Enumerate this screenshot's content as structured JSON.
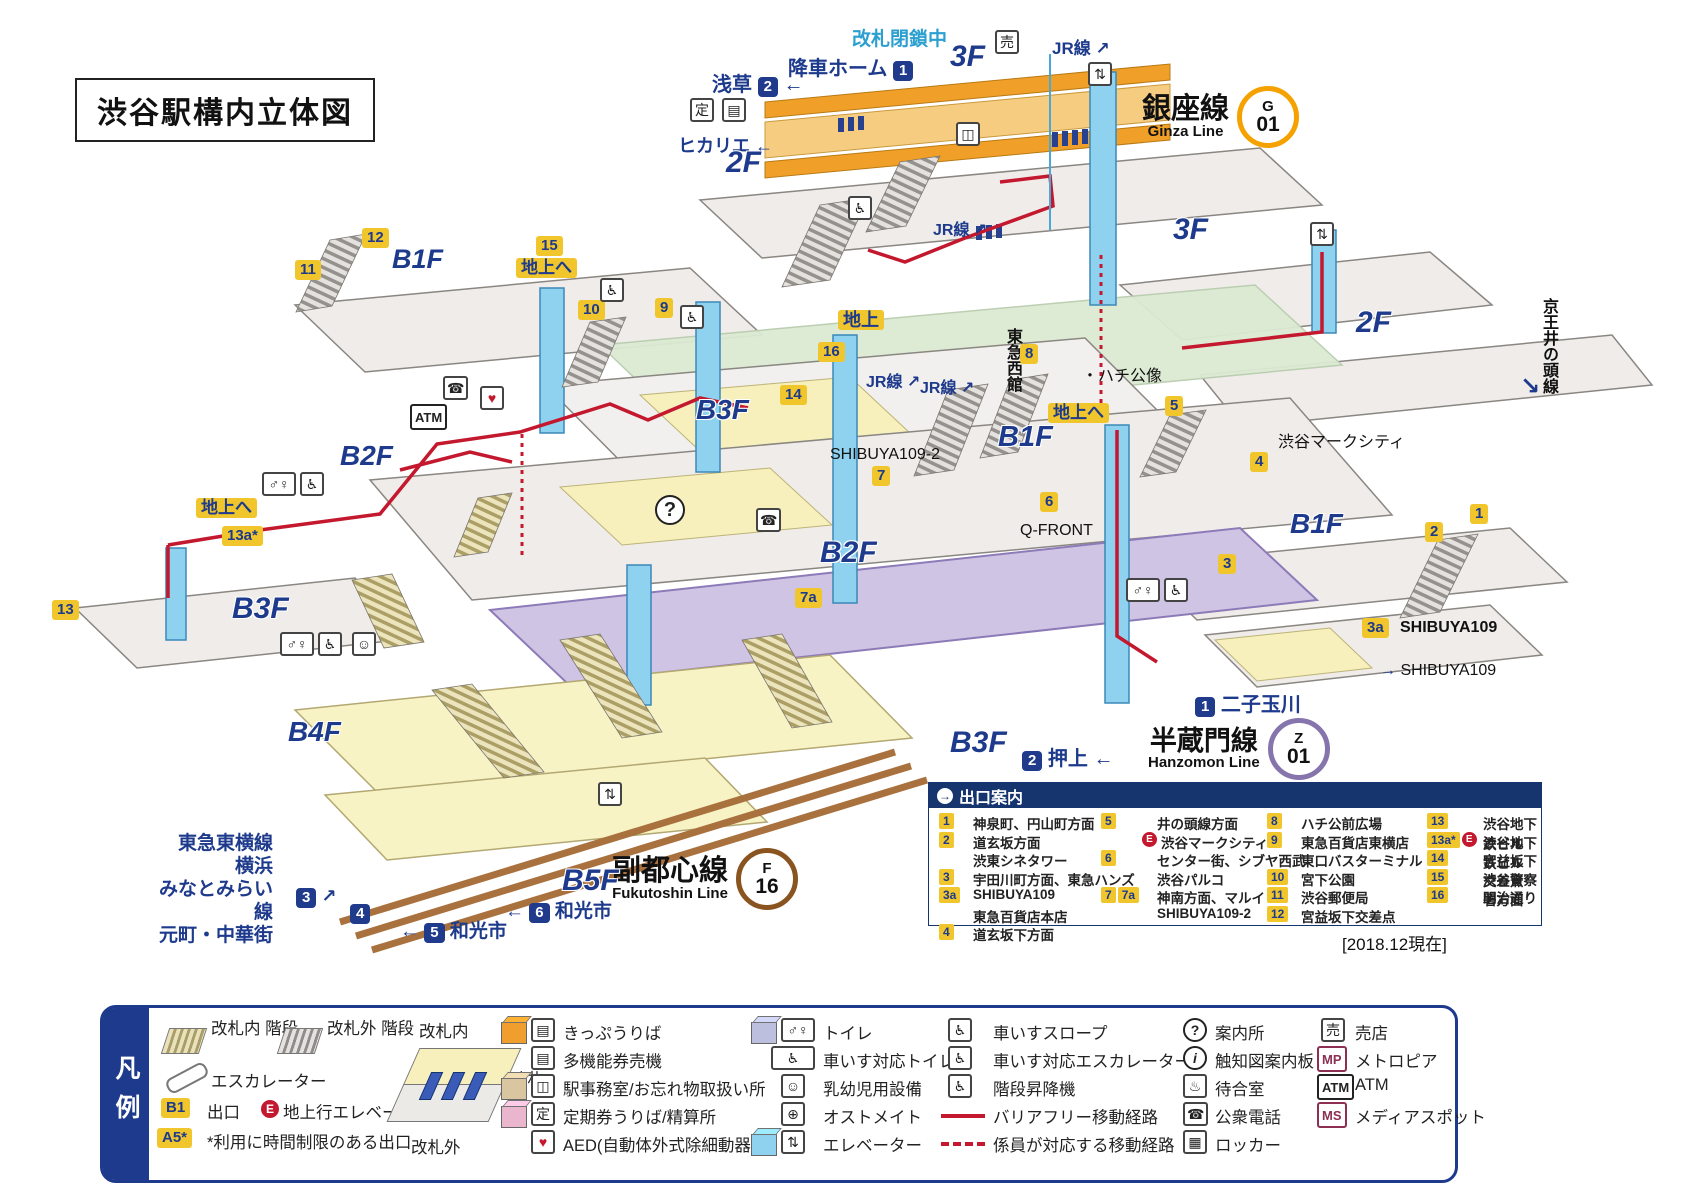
{
  "title": "渋谷駅構内立体図",
  "as_of": "[2018.12現在]",
  "colors": {
    "navy": "#1d3a8c",
    "badge_yellow": "#f0c62c",
    "route_red": "#c3182e",
    "ginza_orange": "#f5a200",
    "hanzomon_purple": "#8674ac",
    "fukutoshin_brown": "#8a5420"
  },
  "icons": {
    "arrow_left": "←",
    "arrow_right": "→",
    "arrow_up_right": "↗",
    "arrow_down_right": "↘",
    "elevator": "⇅",
    "wheelchair": "♿",
    "phone": "☎",
    "heart": "♥",
    "question": "?",
    "info": "i",
    "male_female": "♂♀",
    "shop": "売",
    "pass": "定",
    "ticket": "▤",
    "office": "◫",
    "baby": "☺",
    "ostomate": "⊕",
    "bench": "♨",
    "locker": "▦",
    "mp": "MP",
    "atm": "ATM",
    "ms": "MS",
    "dot": "・"
  },
  "lines": {
    "ginza": {
      "name": "銀座線",
      "en": "Ginza Line",
      "letter": "G",
      "number": "01"
    },
    "hanzomon": {
      "name": "半蔵門線",
      "en": "Hanzomon Line",
      "letter": "Z",
      "number": "01"
    },
    "fukutoshin": {
      "name": "副都心線",
      "en": "Fukutoshin Line",
      "letter": "F",
      "number": "16"
    }
  },
  "map": {
    "kaisatsu_heisa": "改札閉鎖中",
    "kosha_home": "降車ホーム",
    "kosha_badge": "1",
    "asakusa": "浅草",
    "asakusa_badge": "2",
    "hikarie": "ヒカリエ",
    "jr": "JR線",
    "f3_top": "3F",
    "f2_left": "2F",
    "f3_right": "3F",
    "f2_right": "2F",
    "b1f_left": "B1F",
    "b1f_mid": "B1F",
    "b1f_right": "B1F",
    "b2f_left": "B2F",
    "b2f_mid": "B2F",
    "b3f_upper": "B3F",
    "b3f_left": "B3F",
    "b3f_bottom": "B3F",
    "b4f": "B4F",
    "b5f": "B5F",
    "chijo": "地上",
    "chijo_e1": "地上へ",
    "chijo_e2": "地上へ",
    "chijo_e3": "地上へ",
    "hachiko": "・ハチ公像",
    "tokyu_west": "東急西館",
    "mark_city": "渋谷マークシティ",
    "shibuya109_2": "SHIBUYA109-2",
    "qfront": "Q-FRONT",
    "shibuya109_a": "SHIBUYA109",
    "shibuya109_b": "SHIBUYA109",
    "keio": "京王井の頭線",
    "futako": "二子玉川",
    "futako_badge": "1",
    "oshiage": "押上",
    "oshiage_badge": "2",
    "wako5": "和光市",
    "wako5_badge": "5",
    "wako6": "和光市",
    "wako6_badge": "6",
    "badge3n": "3",
    "badge4n": "4",
    "toyoko_block": "東急東横線\n横浜\nみなとみらい線\n元町・中華街",
    "atm_label": "ATM",
    "exit_badges": {
      "e1": "1",
      "e2": "2",
      "e3": "3",
      "e3a": "3a",
      "e4": "4",
      "e5": "5",
      "e6": "6",
      "e7": "7",
      "e7a": "7a",
      "e8": "8",
      "e9": "9",
      "e10": "10",
      "e11": "11",
      "e12": "12",
      "e13": "13",
      "e13a": "13a*",
      "e14": "14",
      "e15": "15",
      "e16": "16"
    }
  },
  "exit_guide": {
    "header": "出口案内",
    "col1": [
      {
        "b1": "1",
        "text": "神泉町、円山町方面"
      },
      {
        "b1": "2",
        "text": "道玄坂方面"
      },
      {
        "b1": "",
        "text": "渋東シネタワー"
      },
      {
        "b1": "3",
        "text": "宇田川町方面、東急ハンズ"
      },
      {
        "b1": "3a",
        "text": "SHIBUYA109"
      },
      {
        "b1": "",
        "text": "東急百貨店本店"
      },
      {
        "b1": "4",
        "text": "道玄坂下方面"
      }
    ],
    "col2": [
      {
        "b1": "5",
        "e": "",
        "text": "井の頭線方面"
      },
      {
        "b1": "",
        "e": "E",
        "text": "渋谷マークシティ"
      },
      {
        "b1": "6",
        "e": "",
        "text": "センター街、シブヤ西武"
      },
      {
        "b1": "",
        "e": "",
        "text": "渋谷パルコ"
      },
      {
        "b1": "7",
        "b2": "7a",
        "e": "",
        "text": "神南方面、マルイ"
      },
      {
        "b1": "",
        "e": "",
        "text": "SHIBUYA109-2"
      }
    ],
    "col3": [
      {
        "b1": "8",
        "text": "ハチ公前広場"
      },
      {
        "b1": "9",
        "text": "東急百貨店東横店"
      },
      {
        "b1": "",
        "text": "東口バスターミナル"
      },
      {
        "b1": "10",
        "text": "宮下公園"
      },
      {
        "b1": "11",
        "text": "渋谷郵便局"
      },
      {
        "b1": "12",
        "text": "宮益坂下交差点"
      }
    ],
    "col4": [
      {
        "b1": "13",
        "e": "",
        "text": "渋谷地下鉄ビル"
      },
      {
        "b1": "13a*",
        "e": "E",
        "text": "渋谷地下鉄ビル"
      },
      {
        "b1": "14",
        "e": "",
        "text": "宮益坂下交差点"
      },
      {
        "b1": "15",
        "e": "",
        "text": "渋谷警察署方面"
      },
      {
        "b1": "16",
        "e": "",
        "text": "明治通り"
      }
    ]
  },
  "legend": {
    "tab": "凡例",
    "stairs_in": "改札内\n階段",
    "stairs_out": "改札外\n階段",
    "escalator": "エスカレーター",
    "exit_badge": "B1",
    "exit_label": "出口",
    "elev_e": "E",
    "elev_label": "地上行エレベーター",
    "limited_badge": "A5*",
    "limited_label": "*利用に時間制限のある出口",
    "gate_inside": "改札内",
    "gate": "改札",
    "gate_outside": "改札外",
    "colC": [
      "きっぷうりば",
      "多機能券売機",
      "駅事務室/お忘れ物取扱い所",
      "定期券うりば/精算所",
      "AED(自動体外式除細動器)"
    ],
    "colD": [
      "トイレ",
      "車いす対応トイレ",
      "乳幼児用設備",
      "オストメイト",
      "エレベーター"
    ],
    "colE": [
      "車いすスロープ",
      "車いす対応エスカレーター",
      "階段昇降機",
      "バリアフリー移動経路",
      "係員が対応する移動経路"
    ],
    "colF": [
      "案内所",
      "触知図案内板",
      "待合室",
      "公衆電話",
      "ロッカー"
    ],
    "colG": [
      "売店",
      "メトロピア",
      "ATM",
      "メディアスポット"
    ]
  }
}
